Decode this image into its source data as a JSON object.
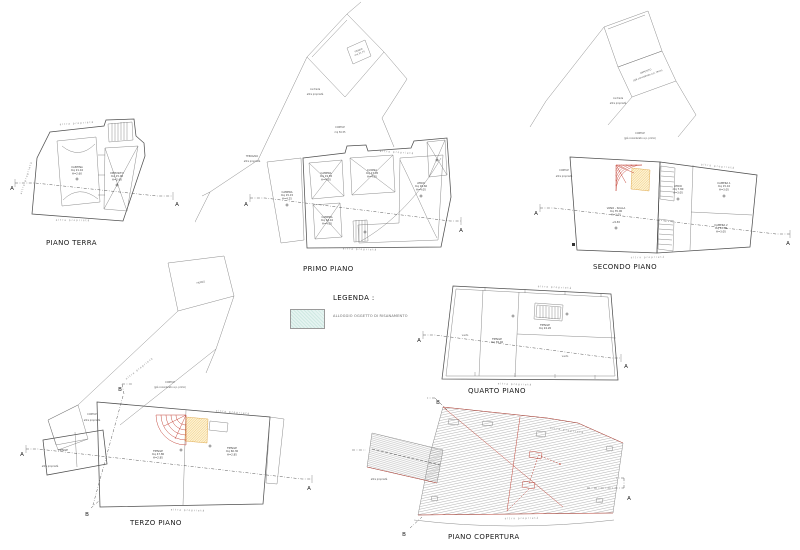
{
  "document": {
    "background": "#ffffff"
  },
  "colors": {
    "renovation_fill": "#e3f3f0",
    "renovation_hatch": "#c6e5de",
    "drawing_line": "#4f4f4f",
    "red_accent": "#c0392b",
    "orange_accent": "#e0a33c",
    "roof_hatch_line": "#8f8f8f"
  },
  "legend": {
    "title": "LEGENDA :",
    "item_label": "ALLOGGIO OGGETTO DI RISANAMENTO"
  },
  "common": {
    "boundary": "altra proprietà",
    "contrada_l1": "contrada",
    "contrada_l2": "altra proprietà",
    "cortile": "CORTILE",
    "cortile_gia": "(già considerato a p. primo)",
    "section_a": "A",
    "section_b": "B"
  },
  "plans": [
    {
      "title": "PIANO TERRA",
      "rooms": [
        {
          "l1": "CANTINA",
          "l2": "mq 21.10",
          "l3": "H=2.60"
        },
        {
          "l1": "DEPOSITO",
          "l2": "mq 15.00",
          "l3": "H=2.60"
        }
      ]
    },
    {
      "title": "PRIMO PIANO",
      "terrazza": "TERRAZZA",
      "cortile_mq": "mq 56.55",
      "fienile_l1": "FIENILE",
      "fienile_l2": "mq 31.70",
      "rooms": [
        {
          "l1": "CAMERA",
          "l2": "mq 15.15",
          "l3": "H=4.25"
        },
        {
          "l1": "CAMERA",
          "l2": "mq 19.55",
          "l3": "H=4.05"
        },
        {
          "l1": "CUCINA",
          "l2": "mq 17.05",
          "l3": "H=4.05"
        },
        {
          "l1": "CAMERA",
          "l2": "mq 14.10",
          "l3": "H=4.05"
        },
        {
          "l1": "ATRIO",
          "l2": "mq 16.60",
          "l3": "H=4.05"
        }
      ]
    },
    {
      "title": "SECONDO PIANO",
      "annex_l1": "DEPOSITO",
      "annex_l2": "(già considerato a p. terzo)",
      "level": "+9.30",
      "rooms": [
        {
          "l1": "VANO - SCALA",
          "l2": "mq 35.00",
          "l3": "H=3.05"
        },
        {
          "l1": "ATRIO",
          "l2": "mq 7.80",
          "l3": "H=3.05"
        },
        {
          "l1": "CAMERA 1",
          "l2": "mq 15.10",
          "l3": "H=3.05"
        },
        {
          "l1": "CAMERA 2",
          "l2": "mq 12.85",
          "l3": "H=3.05"
        }
      ]
    },
    {
      "title": "TERZO PIANO",
      "upper_label": "FIENILE",
      "rooms": [
        {
          "l1": "FIENILE",
          "l2": "mq 47.80",
          "l3": "H=2.85"
        },
        {
          "l1": "FIENILE",
          "l2": "mq 60.30",
          "l3": "H=2.85"
        },
        {
          "l1": "FIENILE"
        }
      ]
    },
    {
      "title": "QUARTO PIANO",
      "rooms": [
        {
          "l1": "FIENILE",
          "l2": "mq 39.40"
        },
        {
          "l1": "FIENILE",
          "l2": "mq 24.20"
        },
        {
          "l1": "vuoto"
        },
        {
          "l1": "vuoto"
        }
      ]
    },
    {
      "title": "PIANO COPERTURA"
    }
  ]
}
